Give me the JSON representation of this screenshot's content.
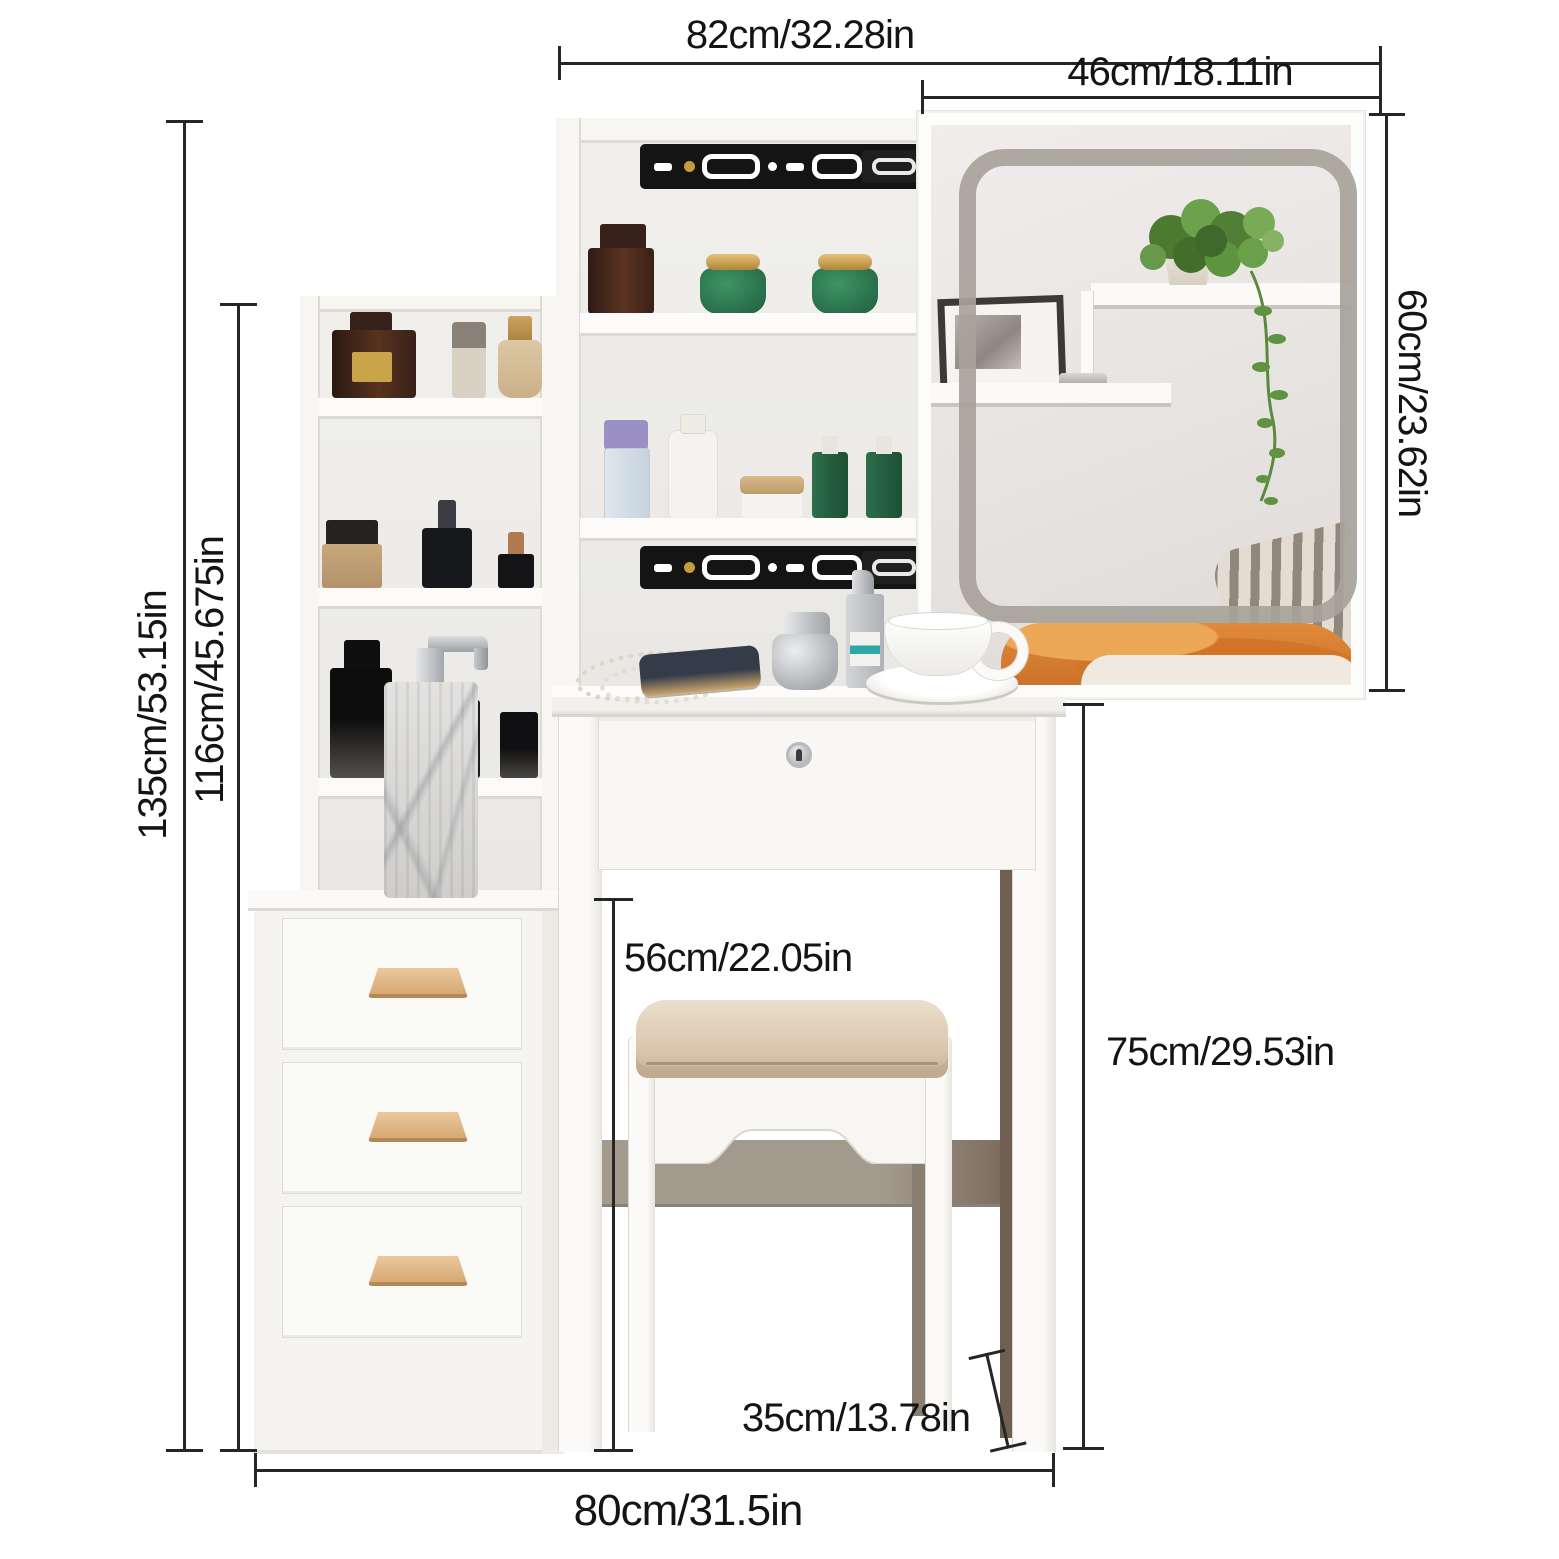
{
  "dimensions": {
    "top_width": "82cm/32.28in",
    "mirror_width": "46cm/18.11in",
    "mirror_height": "60cm/23.62in",
    "total_height": "135cm/53.15in",
    "shelf_height": "116cm/45.675in",
    "stool_height": "56cm/22.05in",
    "desk_height": "75cm/29.53in",
    "stool_depth": "35cm/13.78in",
    "base_width": "80cm/31.5in"
  },
  "palette": {
    "dimension_line": "#262626",
    "furniture_white": "#f7f6f3",
    "wood_handle": "#d9ad77",
    "slide_rail_black": "#141414",
    "cushion_beige": "#dcc9b0",
    "led_frame_gray": "#a7a29a",
    "plant_green": "#5d8f3e",
    "blanket_orange": "#dd8434",
    "stretcher_taupe": "#9d9387"
  }
}
